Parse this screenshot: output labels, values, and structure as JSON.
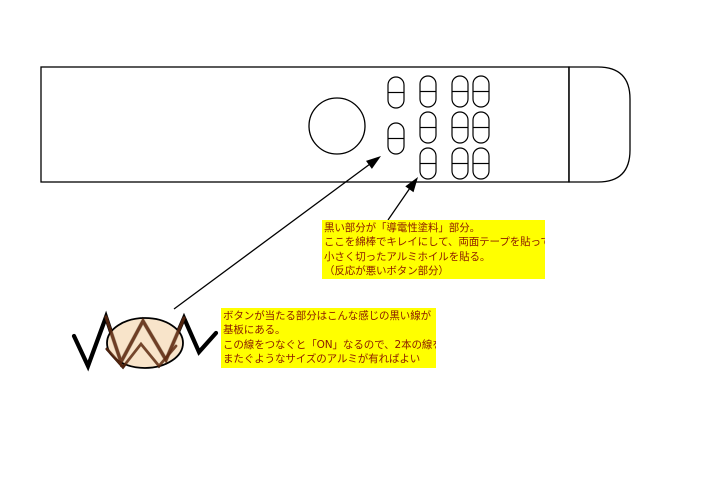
{
  "notes": {
    "conductive_paint": {
      "lines": [
        "黒い部分が「導電性塗料」部分。",
        "ここを綿棒でキレイにして、両面テープを貼って",
        "小さく切ったアルミホイルを貼る。",
        "（反応が悪いボタン部分）"
      ],
      "bg_color": "#ffff00",
      "text_color": "#8b1a00"
    },
    "pcb_trace": {
      "lines": [
        "ボタンが当たる部分はこんな感じの黒い線が",
        "基板にある。",
        "この線をつなぐと「ON」なるので、2本の線を",
        "またぐようなサイズのアルミが有ればよい"
      ],
      "bg_color": "#ffff00",
      "text_color": "#8b1a00"
    }
  },
  "drawing": {
    "remote_outline": "remote-control-body",
    "big_round_button": "circle-button",
    "small_buttons_count": 11,
    "foil_fill_color": "#f6ddbb",
    "line_color": "#000000",
    "note_bg_color": "#ffff00",
    "note_text_color": "#8b1a00"
  }
}
